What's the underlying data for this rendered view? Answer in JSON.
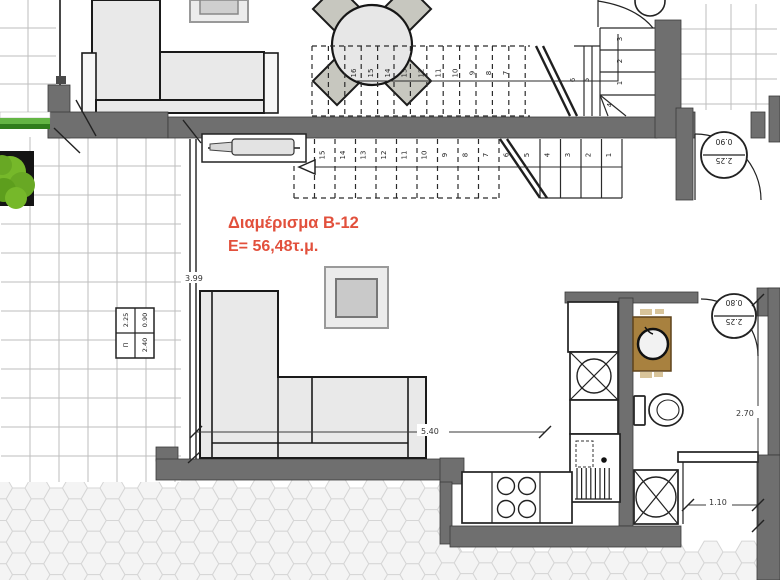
{
  "plan": {
    "apartment_label": "Διαμέρισμα Β-12",
    "area_label": "E= 56,48τ.μ.",
    "dims": {
      "terrace_depth": "3.99",
      "living_width": "5.40",
      "bath_depth": "2.70",
      "shower_width": "1.10"
    },
    "door_tags": [
      {
        "width": "0.90",
        "height": "2.25"
      },
      {
        "width": "0.80",
        "height": "2.25"
      }
    ],
    "window_tag": {
      "tl": "2.25",
      "tr": "0.90",
      "bl": "Π",
      "br": "2.40"
    },
    "stairs": {
      "upper_dashed_numbers": [
        "16",
        "15",
        "14",
        "13",
        "12",
        "11",
        "10",
        "9",
        "8",
        "7"
      ],
      "upper_solid_numbers": [
        "6",
        "5"
      ],
      "winder_numbers": [
        "1",
        "2",
        "3",
        "4"
      ],
      "lower_numbers": [
        "16",
        "15",
        "14",
        "13",
        "12",
        "11",
        "10",
        "9",
        "8",
        "7",
        "6",
        "5",
        "4",
        "3",
        "2",
        "1"
      ]
    },
    "colors": {
      "wall": "#6f6f6f",
      "label_red": "#e2503c",
      "vanity_brown": "#a8813f",
      "bush_green": "#76b82a",
      "sofa_gray": "#e9e9e9"
    }
  }
}
